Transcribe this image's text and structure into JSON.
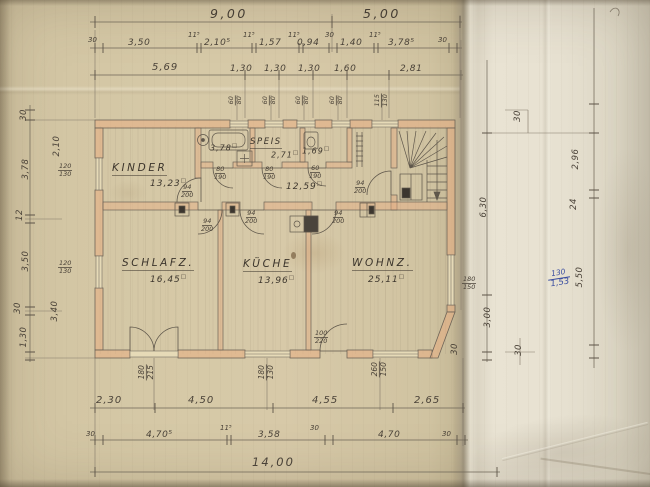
{
  "units": {
    "m2": "□"
  },
  "rooms": {
    "kinder": {
      "name": "KINDER",
      "area": "13,23"
    },
    "bad": {
      "area": "3,78"
    },
    "speis": {
      "name": "SPEIS",
      "area": "2,71"
    },
    "wc": {
      "area": "1,69"
    },
    "flur": {
      "area": "12,59"
    },
    "schlafz": {
      "name": "SCHLAFZ.",
      "area": "16,45"
    },
    "kueche": {
      "name": "KÜCHE",
      "area": "13,96"
    },
    "wohnz": {
      "name": "WOHNZ.",
      "area": "25,11"
    }
  },
  "dims": {
    "top1": [
      "9,00",
      "5,00"
    ],
    "top2": [
      "30",
      "3,50",
      "11⁵",
      "2,10⁵",
      "11⁵",
      "1,57",
      "11⁵",
      "0,94",
      "30",
      "1,40",
      "11⁵",
      "3,78⁵",
      "30"
    ],
    "top3": [
      "5,69",
      "1,30",
      "1,30",
      "1,30",
      "1,60",
      "2,81"
    ],
    "bottom1": [
      "2,30",
      "4,50",
      "4,55",
      "2,65"
    ],
    "bottom2": [
      "30",
      "4,70⁵",
      "11⁵",
      "3,58",
      "30",
      "4,70",
      "30"
    ],
    "bottom3": [
      "14,00"
    ],
    "left_outer": [
      "30",
      "3,78",
      "12",
      "3,50",
      "30",
      "1,30"
    ],
    "left_inner": [
      "2,10",
      "3,40"
    ],
    "right_inner": [
      "6,30",
      "3,00",
      "30"
    ],
    "right_outer": [
      "30",
      "2,96",
      "24",
      "5,50",
      "30"
    ]
  },
  "openings": {
    "windows_top": [
      {
        "w": "60",
        "h": "80"
      },
      {
        "w": "60",
        "h": "80"
      },
      {
        "w": "60",
        "h": "80"
      },
      {
        "w": "60",
        "h": "80"
      },
      {
        "w": "115",
        "h": "130"
      }
    ],
    "windows_bottom": [
      {
        "w": "180",
        "h": "215"
      },
      {
        "w": "180",
        "h": "130"
      },
      {
        "w": "260",
        "h": "150"
      }
    ],
    "windows_left": [
      {
        "w": "120",
        "h": "130"
      },
      {
        "w": "120",
        "h": "130"
      }
    ],
    "windows_right": [
      {
        "w": "180",
        "h": "150"
      }
    ],
    "doors": {
      "kinder": {
        "w": "94",
        "h": "200"
      },
      "bad": {
        "w": "80",
        "h": "190"
      },
      "speis": {
        "w": "80",
        "h": "190"
      },
      "wc": {
        "w": "60",
        "h": "190"
      },
      "stairs": {
        "w": "94",
        "h": "200"
      },
      "schlafz": {
        "w": "94",
        "h": "200"
      },
      "kueche": {
        "w": "94",
        "h": "200"
      },
      "wohnz": {
        "w": "94",
        "h": "200"
      },
      "entrance": {
        "w": "100",
        "h": "220"
      }
    }
  },
  "annotations": {
    "blue_note": {
      "numerator": "130",
      "denominator": "1,53"
    }
  },
  "colors": {
    "paper": "#d3c6a4",
    "flap": "#e7e1d1",
    "wall_fill": "#e7ad82",
    "line": "#5d564c",
    "blue_ink": "#3a4da0"
  }
}
